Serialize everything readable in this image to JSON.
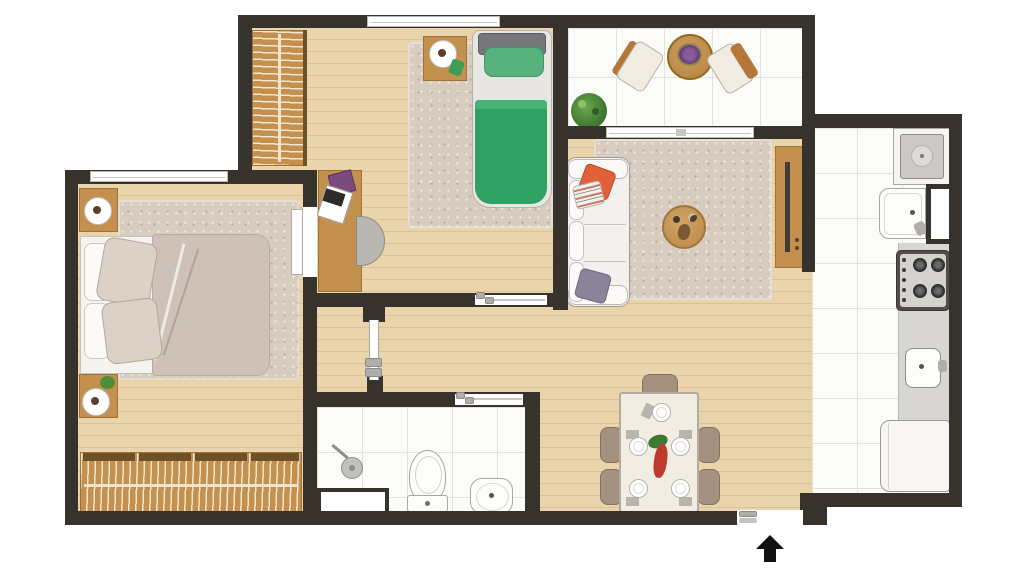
{
  "app": {
    "name": "apartment-floor-plan",
    "canvas_width": 1024,
    "canvas_height": 576
  },
  "palette": {
    "wall": "#38322c",
    "wood_floor": "#e9d4ab",
    "wood_plank_line": "#b08448",
    "tile": "#fbfbfa",
    "tile_line": "#e3e2df",
    "rug_beige": "#d7ccbe",
    "furniture_wood": "#c3914d",
    "white_fixture": "#f5f4f1",
    "fixture_outline": "#a9a7a3",
    "bed_green": "#2fa263",
    "bed_green_pillow": "#57b27e",
    "duvet_beige": "#cec2b8",
    "sofa_white": "#f2f1ef",
    "pillow_orange": "#e0603a",
    "pillow_purple": "#8b8498",
    "chair_brown": "#a5917f",
    "stove_dark": "#504d4a",
    "counter_gray": "#d8d6d3",
    "arrow_black": "#111111"
  },
  "rooms": {
    "master_bedroom": {
      "label": "master-bedroom",
      "furniture": [
        "double-bed",
        "beige-duvet",
        "pillows",
        "shag-rug",
        "nightstand-top",
        "table-lamp",
        "nightstand-bottom",
        "table-lamp",
        "plant-decor",
        "wardrobe-with-hangers",
        "window",
        "swing-door"
      ]
    },
    "bedroom2": {
      "label": "second-bedroom",
      "furniture": [
        "single-bed-green",
        "headboard",
        "rug",
        "nightstand",
        "table-lamp",
        "desk",
        "laptop",
        "book",
        "desk-chair",
        "wardrobe-with-hangers",
        "window",
        "sliding-door"
      ]
    },
    "balcony": {
      "label": "balcony",
      "furniture": [
        "round-table",
        "flower-pot",
        "armchair-left",
        "armchair-right",
        "potted-plant",
        "sliding-glass-door"
      ]
    },
    "living_room": {
      "label": "living-room",
      "furniture": [
        "sofa",
        "orange-pillow",
        "striped-pillow",
        "purple-pillow",
        "shag-rug",
        "round-coffee-table",
        "decor-items",
        "tv-cabinet",
        "tv"
      ]
    },
    "dining_area": {
      "label": "dining-area",
      "furniture": [
        "dining-table",
        "plates-5",
        "centerpiece-flowers",
        "chair-top",
        "chair-left-1",
        "chair-left-2",
        "chair-right-1",
        "chair-right-2"
      ]
    },
    "bathroom": {
      "label": "bathroom",
      "furniture": [
        "shower-head",
        "shower-tray",
        "toilet",
        "pedestal-sink",
        "sliding-door"
      ]
    },
    "kitchen": {
      "label": "kitchen",
      "furniture": [
        "laundry-tank-sink",
        "kitchen-sink",
        "service-window",
        "stove-4-burners",
        "counter",
        "counter-sink",
        "refrigerator"
      ]
    },
    "hallway": {
      "label": "hallway",
      "furniture": [
        "pocket-door"
      ]
    }
  },
  "indicators": {
    "entrance_arrow": "up-arrow-entrance"
  }
}
